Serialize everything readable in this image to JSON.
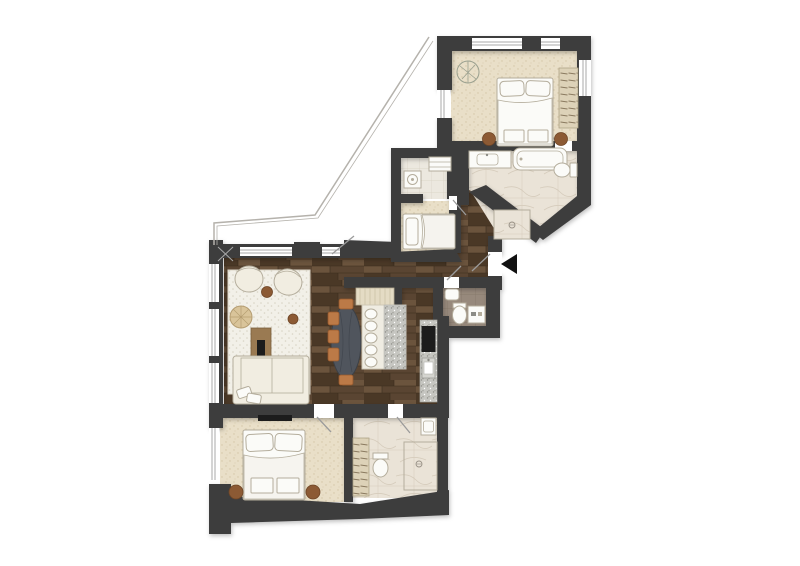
{
  "colors": {
    "background": "#ffffff",
    "wall": "#3e3d3e",
    "wood_dark": "#4a3826",
    "wood_mid": "#5a4532",
    "wood_light": "#6b543d",
    "carpet": "#e9dfc8",
    "carpet_dot": "#d3c5a6",
    "rug": "#f2f0e8",
    "rug_dot": "#d8d3c5",
    "marble": "#eae3d7",
    "marble_vein": "#d6ccbc",
    "taupe_tile": "#97897c",
    "utility_tile": "#ece8df",
    "granite": "#c6c6c1",
    "furniture_white": "#fbfbf8",
    "furniture_outline": "#b4ad9c",
    "cream": "#f1ede1",
    "accent_brown": "#8c5a34",
    "chair_orange": "#bc7a47",
    "table_dark": "#50555d",
    "wardrobe_fill": "#ddd2b8",
    "wardrobe_line": "#8a7a5f",
    "tv_black": "#1c1c1c",
    "entrance_arrow": "#111111",
    "terrace_line": "#b5b2ac"
  },
  "rooms": [
    {
      "name": "master-bedroom",
      "furniture": [
        "double-bed",
        "nightstand",
        "nightstand",
        "wardrobe",
        "plant"
      ]
    },
    {
      "name": "master-bathroom",
      "furniture": [
        "vanity-sink",
        "bathtub",
        "toilet",
        "shower"
      ]
    },
    {
      "name": "utility-room",
      "furniture": [
        "washing-machine",
        "shelf"
      ]
    },
    {
      "name": "guest-bed-nook",
      "furniture": [
        "single-bed"
      ]
    },
    {
      "name": "hallway",
      "furniture": [
        "entrance-door",
        "entrance-arrow"
      ]
    },
    {
      "name": "living-room",
      "furniture": [
        "rug",
        "armchair",
        "armchair",
        "sofa",
        "woven-pouf",
        "side-table",
        "tv-console",
        "tv"
      ]
    },
    {
      "name": "kitchen-dining",
      "furniture": [
        "dining-table",
        "dining-chair",
        "kitchen-island",
        "bar-seat",
        "sideboard",
        "kitchen-counter",
        "cooktop",
        "kitchen-sink"
      ]
    },
    {
      "name": "guest-wc",
      "furniture": [
        "sink",
        "toilet",
        "washing-machine"
      ]
    },
    {
      "name": "bedroom-2",
      "furniture": [
        "double-bed",
        "nightstand",
        "nightstand",
        "wardrobe",
        "tv"
      ]
    },
    {
      "name": "bathroom-2",
      "furniture": [
        "toilet",
        "sink",
        "shower"
      ]
    }
  ]
}
